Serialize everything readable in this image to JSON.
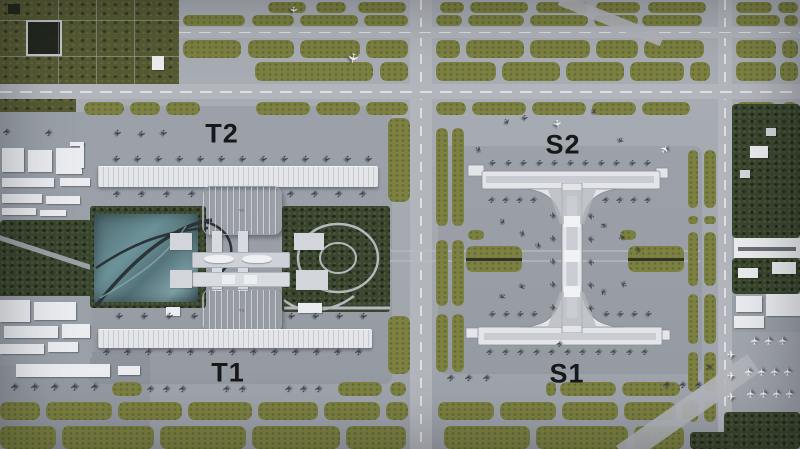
{
  "title": "Airport aerial masterplan with terminals T1, T2 and satellite concourses S1, S2",
  "labels": {
    "t2": "T2",
    "t1": "T1",
    "s2": "S2",
    "s1": "S1",
    "t2_roof": "T2",
    "t1_roof": "T1"
  },
  "icons": {
    "airplane": "✈"
  },
  "colors": {
    "tarmac": "#a6aab1",
    "runway": "#b2b5bb",
    "centerline": "#e8eaed",
    "grass": "#7c8142",
    "grass_light": "#8f9455",
    "field": "#565a33",
    "field_dark": "#23281e",
    "trees": "#3a452f",
    "building_white": "#eaecef",
    "building_gray": "#d3d6db",
    "pier": "#e3e5e9",
    "pier_inner": "#c9ccd2",
    "plane_dark": "#3d4249",
    "plane_white": "#f1f3f5",
    "label": "#17181a"
  }
}
